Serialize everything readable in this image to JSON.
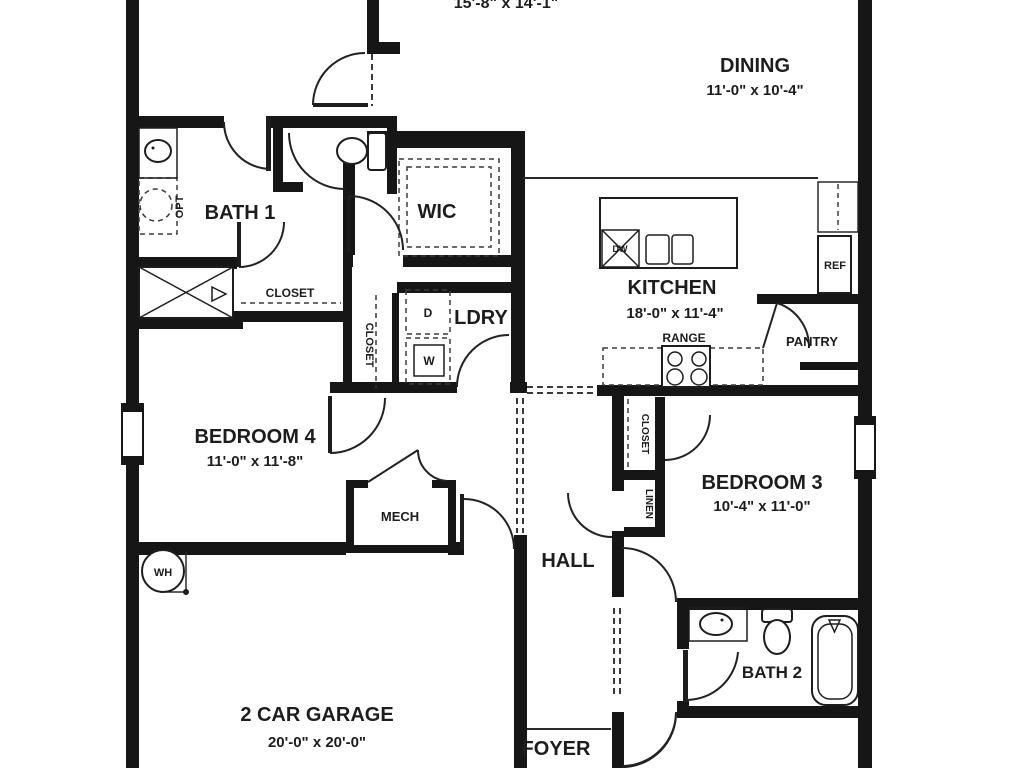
{
  "plan": {
    "title": "single-story house floor plan",
    "colors": {
      "wall": "#161616",
      "line": "#2a2a2a",
      "background": "#ffffff"
    },
    "rooms": {
      "great_room_clipped": {
        "dims": "15'-8\" x 14'-1\""
      },
      "dining": {
        "name": "DINING",
        "dims": "11'-0\" x 10'-4\""
      },
      "kitchen": {
        "name": "KITCHEN",
        "dims": "18'-0\" x 11'-4\""
      },
      "bedroom4": {
        "name": "BEDROOM 4",
        "dims": "11'-0\" x 11'-8\""
      },
      "bedroom3": {
        "name": "BEDROOM 3",
        "dims": "10'-4\" x 11'-0\""
      },
      "garage": {
        "name": "2 CAR GARAGE",
        "dims": "20'-0\" x 20'-0\""
      },
      "bath1": {
        "name": "BATH 1"
      },
      "bath2": {
        "name": "BATH 2"
      },
      "wic": {
        "name": "WIC"
      },
      "ldry": {
        "name": "LDRY"
      },
      "hall": {
        "name": "HALL"
      },
      "foyer": {
        "name": "FOYER"
      },
      "mech": {
        "name": "MECH"
      },
      "pantry": {
        "name": "PANTRY"
      }
    },
    "closets": {
      "bath1_closet": "CLOSET",
      "hall_closet": "CLOSET",
      "bed3_closet": "CLOSET",
      "linen": "LINEN"
    },
    "fixtures": {
      "opt": "OPT",
      "range": "RANGE",
      "ref": "REF",
      "dishwasher": "DW",
      "dryer": "D",
      "washer": "W",
      "water_heater": "WH"
    }
  }
}
